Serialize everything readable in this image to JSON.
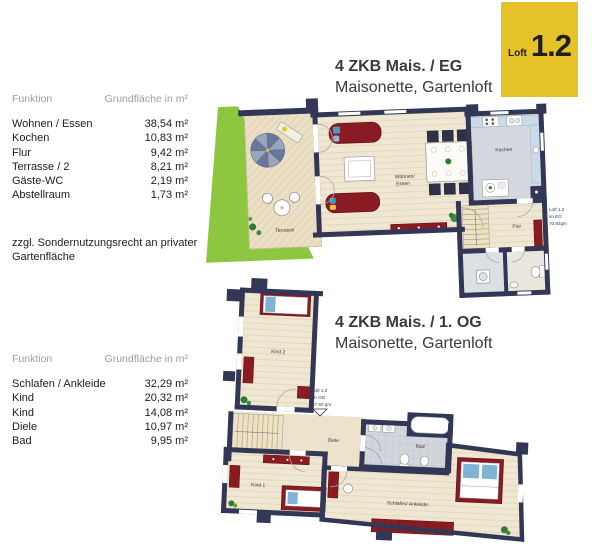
{
  "badge": {
    "label": "Loft",
    "number": "1.2"
  },
  "colors": {
    "badge_yellow": "#e4c228",
    "badge_text": "#201f1c",
    "wall_navy": "#333756",
    "floor_beige": "#f0e7d2",
    "terrace_beige": "#ebdfc6",
    "wet_room_gray": "#d3d7dd",
    "kitchen_counter_blue": "#c9dbe8",
    "furniture_red": "#8a1b22",
    "garden_green": "#8dc63f",
    "text_dark": "#1d1d1b",
    "text_gray": "#9d9d9c",
    "title_gray": "#3a3a39"
  },
  "floors": {
    "eg": {
      "title": "4 ZKB Mais. / EG",
      "subtitle": "Maisonette, Gartenloft",
      "table": {
        "col_function": "Funktion",
        "col_area": "Grundfläche in m²",
        "rows": [
          {
            "label": "Wohnen / Essen",
            "value": "38,54 m²"
          },
          {
            "label": "Kochen",
            "value": "10,83 m²"
          },
          {
            "label": "Flur",
            "value": "9,42 m²"
          },
          {
            "label": "Terrasse / 2",
            "value": "8,21 m²"
          },
          {
            "label": "Gäste-WC",
            "value": "2,19 m²"
          },
          {
            "label": "Abstellraum",
            "value": "1,73 m²"
          }
        ]
      },
      "note": "zzgl. Sondernutzungsrecht an privater Gartenfläche",
      "plan": {
        "room_terrasse": "Terrasse",
        "room_wohnen_line1": "Wohnen/",
        "room_wohnen_line2": "Essen",
        "room_kochen": "Kochen",
        "room_flur": "Flur",
        "annotation": {
          "line1": "Loft 1.2",
          "line2": "im EG",
          "line3": "70,92qm"
        }
      }
    },
    "og": {
      "title": "4 ZKB Mais. / 1. OG",
      "subtitle": "Maisonette, Gartenloft",
      "table": {
        "col_function": "Funktion",
        "col_area": "Grundfläche in m²",
        "rows": [
          {
            "label": "Schlafen / Ankleide",
            "value": "32,29 m²"
          },
          {
            "label": "Kind",
            "value": "20,32 m²"
          },
          {
            "label": "Kind",
            "value": "14,08 m²"
          },
          {
            "label": "Diele",
            "value": "10,97 m²"
          },
          {
            "label": "Bad",
            "value": "9,95 m²"
          }
        ]
      },
      "plan": {
        "room_kind2": "Kind 2",
        "room_kind1": "Kind 1",
        "room_diele": "Diele",
        "room_bad": "Bad",
        "room_schlafen": "Schlafen/ Ankleide",
        "annotation": {
          "line1": "Loft 1.2",
          "line2": "im OG",
          "line3": "87,60 qm"
        }
      }
    }
  }
}
